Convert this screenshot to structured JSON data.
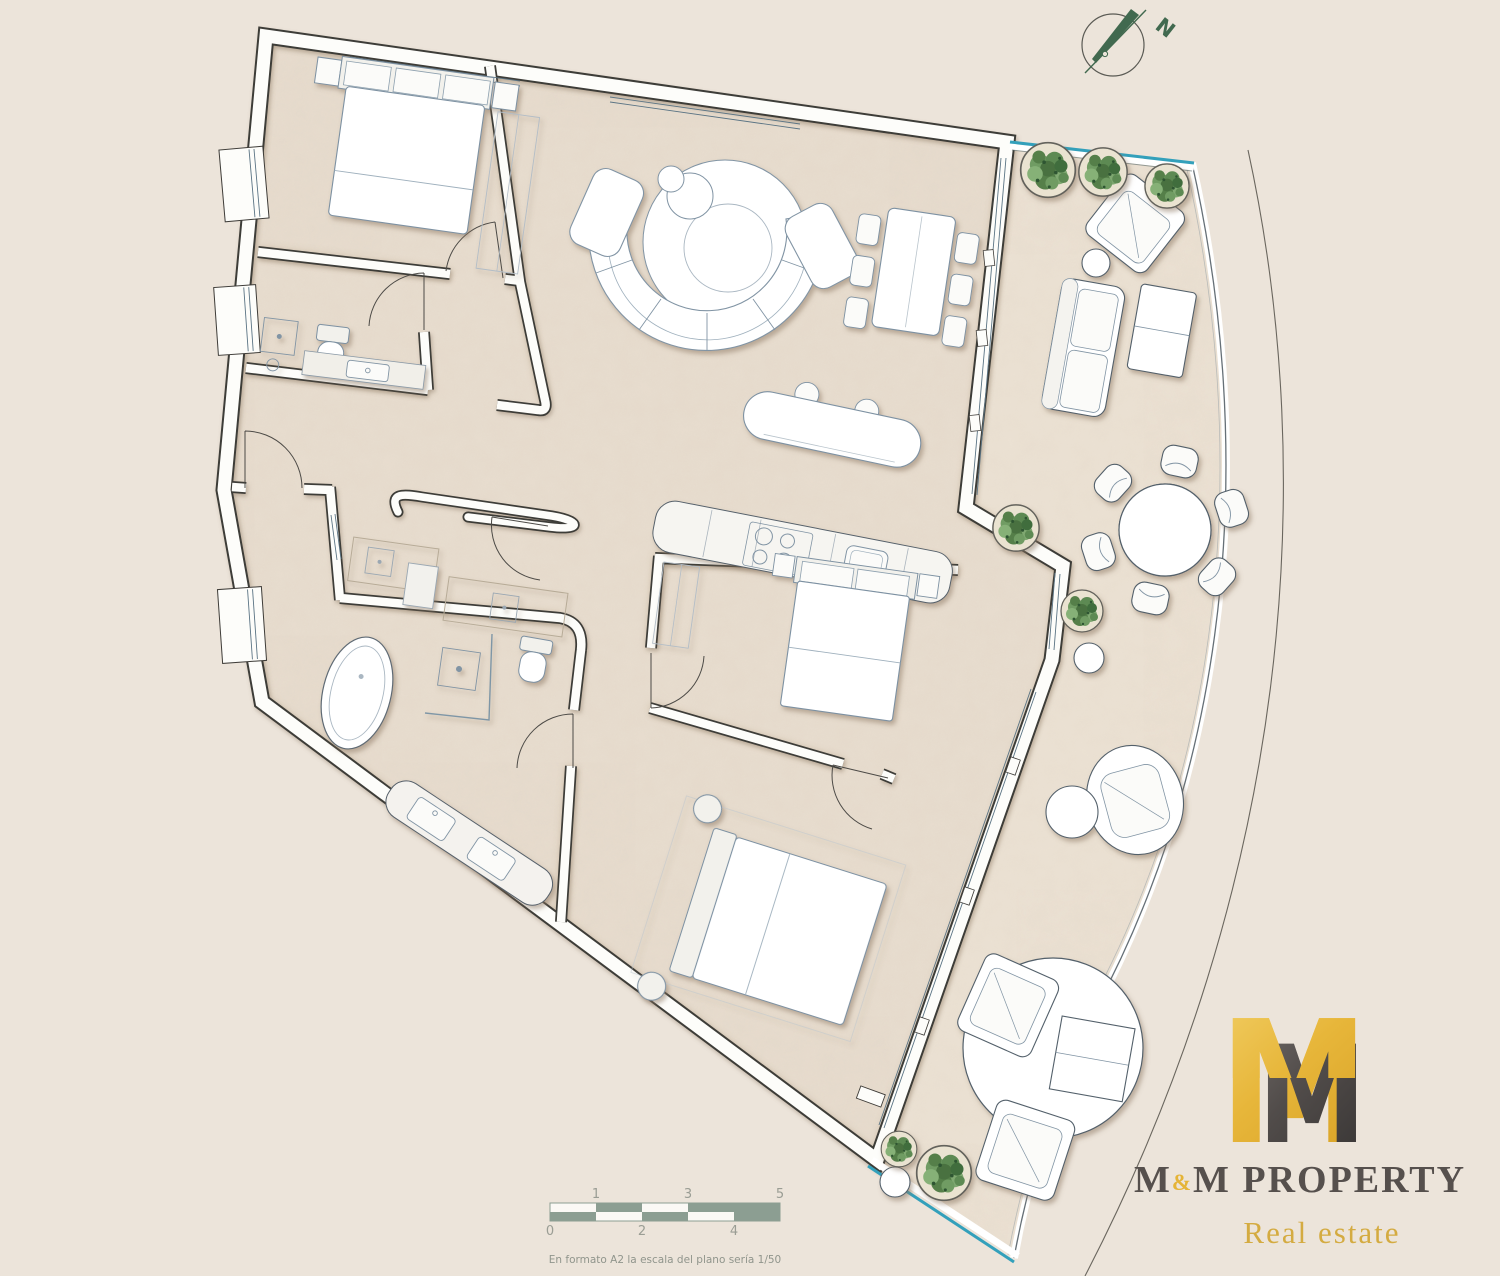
{
  "page": {
    "background": "#ece4da",
    "width": 1500,
    "height": 1276
  },
  "compass": {
    "label": "N",
    "color": "#41694f",
    "ring_color": "#5a5a54"
  },
  "plan": {
    "wall_fill": "#fdfdfa",
    "wall_outline": "#3e3c38",
    "floor_color": "#e8ddcf",
    "terrace_floor_color": "#ece2d4",
    "furniture_outline": "#7d91a2",
    "outdoor_furniture_outline": "#53606b",
    "glass_railing_color": "#33a0bb",
    "window_glazing_color": "#5b7484",
    "door_arc_color": "#4c4a46",
    "plant_green": "#6f9c63",
    "boundary_line_color": "#6a665e"
  },
  "logo": {
    "monogram_left": "M",
    "monogram_right": "M",
    "gold": "#e5b437",
    "dark": "#46413f",
    "wordmark_m1": "M",
    "wordmark_amp": "&",
    "wordmark_m2": "M PROPERTY",
    "wordmark_color": "#56504d",
    "tagline": "Real estate",
    "tagline_color": "#d4ab41"
  },
  "scale_bar": {
    "top_labels": [
      "1",
      "3",
      "5"
    ],
    "bottom_labels": [
      "0",
      "2",
      "4"
    ],
    "caption": "En formato A2 la escala del plano sería 1/50",
    "bar_color": "#8c9e92",
    "label_color": "#9a9d94",
    "caption_color": "#90958c"
  }
}
